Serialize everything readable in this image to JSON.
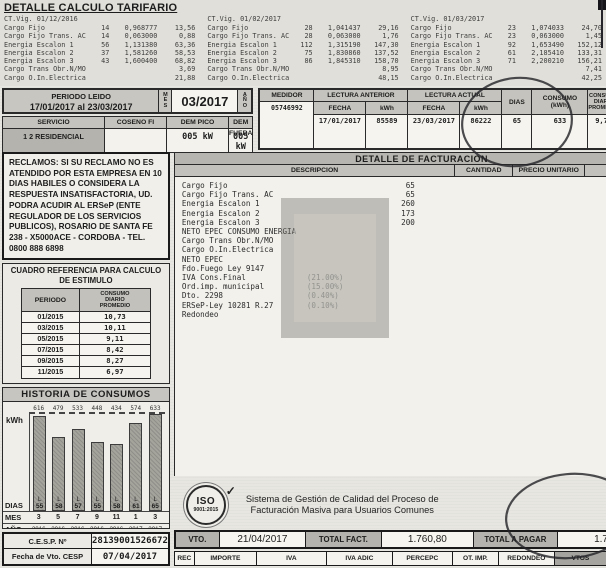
{
  "tarifario": {
    "title": "DETALLE CALCULO TARIFARIO",
    "blocks": [
      {
        "vigencia": "CT.Vig. 01/12/2016",
        "rows": [
          {
            "label": "Cargo Fijo",
            "qty": "14",
            "price": "0,968777",
            "amount": "13,56"
          },
          {
            "label": "Cargo Fijo Trans. AC",
            "qty": "14",
            "price": "0,063000",
            "amount": "0,88"
          },
          {
            "label": "Energia Escalon 1",
            "qty": "56",
            "price": "1,131380",
            "amount": "63,36"
          },
          {
            "label": "Energia Escalon 2",
            "qty": "37",
            "price": "1,581260",
            "amount": "58,53"
          },
          {
            "label": "Energia Escalon 3",
            "qty": "43",
            "price": "1,600400",
            "amount": "68,82"
          },
          {
            "label": "Cargo Trans Obr.N/MO",
            "qty": "",
            "price": "",
            "amount": "3,69"
          },
          {
            "label": "Cargo O.In.Electrica",
            "qty": "",
            "price": "",
            "amount": "21,88"
          }
        ]
      },
      {
        "vigencia": "CT.Vig. 01/02/2017",
        "rows": [
          {
            "label": "Cargo Fijo",
            "qty": "28",
            "price": "1,041437",
            "amount": "29,16"
          },
          {
            "label": "Cargo Fijo Trans. AC",
            "qty": "28",
            "price": "0,063000",
            "amount": "1,76"
          },
          {
            "label": "Energia Escalon 1",
            "qty": "112",
            "price": "1,315190",
            "amount": "147,30"
          },
          {
            "label": "Energia Escalon 2",
            "qty": "75",
            "price": "1,830860",
            "amount": "137,52"
          },
          {
            "label": "Energia Escalon 3",
            "qty": "86",
            "price": "1,845310",
            "amount": "158,70"
          },
          {
            "label": "Cargo Trans Obr.N/MO",
            "qty": "",
            "price": "",
            "amount": "8,95"
          },
          {
            "label": "Cargo O.In.Electrica",
            "qty": "",
            "price": "",
            "amount": "48,15"
          }
        ]
      },
      {
        "vigencia": "CT.Vig. 01/03/2017",
        "rows": [
          {
            "label": "Cargo Fijo",
            "qty": "23",
            "price": "1,074033",
            "amount": "24,70"
          },
          {
            "label": "Cargo Fijo Trans. AC",
            "qty": "23",
            "price": "0,063000",
            "amount": "1,45"
          },
          {
            "label": "Energia Escalon 1",
            "qty": "92",
            "price": "1,653490",
            "amount": "152,12"
          },
          {
            "label": "Energia Escalon 2",
            "qty": "61",
            "price": "2,185410",
            "amount": "133,31"
          },
          {
            "label": "Energia Escalon 3",
            "qty": "71",
            "price": "2,200210",
            "amount": "156,21"
          },
          {
            "label": "Cargo Trans Obr.N/MO",
            "qty": "",
            "price": "",
            "amount": "7,41"
          },
          {
            "label": "Cargo O.In.Electrica",
            "qty": "",
            "price": "",
            "amount": "42,25"
          }
        ]
      }
    ]
  },
  "periodo": {
    "label": "PERIODO LEIDO",
    "rango": "17/01/2017 al 23/03/2017",
    "mes_label": "MES",
    "mes": "03/2017",
    "ano_label": "AÑO",
    "servicio_label": "SERVICIO",
    "servicio": "1 2 RESIDENCIAL",
    "coseno_label": "COSENO FI",
    "coseno": "",
    "dem_pico_label": "DEM PICO",
    "dem_pico": "005 kW",
    "dem_fuera_label": "DEM FUERA",
    "dem_fuera": "005 kW"
  },
  "medidor": {
    "label": "MEDIDOR",
    "numero": "05746992",
    "lectura_anterior_label": "LECTURA ANTERIOR",
    "lectura_actual_label": "LECTURA ACTUAL",
    "fecha_label": "FECHA",
    "kwh_label": "kWh",
    "anterior_fecha": "17/01/2017",
    "anterior_kwh": "85589",
    "actual_fecha": "23/03/2017",
    "actual_kwh": "86222",
    "dias_label": "DIAS",
    "dias": "65",
    "consumo_l1": "CONSUMO",
    "consumo_l2": "(kWh)",
    "consumo": "633",
    "promedio_l1": "CONSUMO",
    "promedio_l2": "DIARIO",
    "promedio_l3": "PROMEDIO",
    "promedio": "9,73"
  },
  "reclamos": {
    "text": "RECLAMOS: SI SU RECLAMO NO ES ATENDIDO POR ESTA EMPRESA EN 10 DIAS HABILES O CONSIDERA LA RESPUESTA INSATISFACTORIA, UD. PODRA ACUDIR AL ERSeP (ENTE REGULADOR DE LOS SERVICIOS PUBLICOS), ROSARIO DE SANTA FE 238 - X5000ACE - CORDOBA - TEL. 0800 888 6898"
  },
  "estimulo": {
    "title1": "CUADRO REFERENCIA PARA CALCULO",
    "title2": "DE ESTIMULO",
    "col_periodo": "PERIODO",
    "col_consumo_l1": "CONSUMO",
    "col_consumo_l2": "DIARIO",
    "col_consumo_l3": "PROMEDIO",
    "rows": [
      {
        "periodo": "01/2015",
        "consumo": "10,73"
      },
      {
        "periodo": "03/2015",
        "consumo": "10,11"
      },
      {
        "periodo": "05/2015",
        "consumo": "9,11"
      },
      {
        "periodo": "07/2015",
        "consumo": "8,42"
      },
      {
        "periodo": "09/2015",
        "consumo": "8,27"
      },
      {
        "periodo": "11/2015",
        "consumo": "6,97"
      }
    ]
  },
  "historia": {
    "title": "HISTORIA DE CONSUMOS",
    "ylabel": "kWh",
    "dias_label": "DIAS",
    "mes_label": "MES",
    "ano_label": "AÑO",
    "leyenda_l": "(L) LECTURA",
    "leyenda_e": "(E) ESTIMADO"
  },
  "chart_data": {
    "type": "bar",
    "title": "HISTORIA DE CONSUMOS",
    "ylabel": "kWh",
    "categories_mes": [
      "3",
      "5",
      "7",
      "9",
      "11",
      "1",
      "3"
    ],
    "categories_ano": [
      "2016",
      "2016",
      "2016",
      "2016",
      "2016",
      "2017",
      "2017"
    ],
    "values": [
      616,
      479,
      533,
      448,
      434,
      574,
      633
    ],
    "dias": [
      "55",
      "58",
      "57",
      "55",
      "58",
      "61",
      "65"
    ],
    "tipo_lectura": [
      "L",
      "L",
      "L",
      "L",
      "L",
      "L",
      "L"
    ],
    "ylim": [
      0,
      650
    ],
    "grid": false,
    "legend": "(L) LECTURA / (E) ESTIMADO"
  },
  "cesp": {
    "nro_label": "C.E.S.P. Nº",
    "nro": "28139001526672",
    "vto_label": "Fecha de Vto. CESP",
    "vto": "07/04/2017"
  },
  "facturacion": {
    "title": "DETALLE DE FACTURACION",
    "col_desc": "DESCRIPCION",
    "col_cant": "CANTIDAD",
    "col_precio": "PRECIO UNITARIO",
    "col_importe": "IMPORTE $",
    "rows": [
      {
        "label": "Cargo Fijo",
        "note": "",
        "qty": "65",
        "amount": "67,42"
      },
      {
        "label": "Cargo Fijo Trans. AC",
        "note": "",
        "qty": "65",
        "amount": "4,09"
      },
      {
        "label": "Energia Escalon 1",
        "note": "",
        "qty": "260",
        "amount": "362,78"
      },
      {
        "label": "Energia Escalon 2",
        "note": "",
        "qty": "173",
        "amount": "329,36"
      },
      {
        "label": "Energia Escalon 3",
        "note": "",
        "qty": "200",
        "amount": "383,73"
      },
      {
        "label": "NETO EPEC CONSUMO ENERGIA",
        "note": "",
        "qty": "",
        "amount": "1.147,38"
      },
      {
        "label": "Cargo Trans Obr.N/MO",
        "note": "",
        "qty": "",
        "amount": "20,05"
      },
      {
        "label": "Cargo O.In.Electrica",
        "note": "",
        "qty": "",
        "amount": "112,28"
      },
      {
        "label": "NETO EPEC",
        "note": "",
        "qty": "",
        "amount": "1.279,71"
      },
      {
        "label": "Fdo.Fuego Ley 9147",
        "note": "",
        "qty": "",
        "amount": "14,00"
      },
      {
        "label": "IVA Cons.Final",
        "note": "(21.00%)",
        "qty": "",
        "amount": "268,74"
      },
      {
        "label": "Ord.imp. municipal",
        "note": "(15.00%)",
        "qty": "",
        "amount": "191,95"
      },
      {
        "label": "Dto. 2298",
        "note": "(0.40%)",
        "qty": "",
        "amount": "5,11"
      },
      {
        "label": "ERSeP-Ley 10281 R.27",
        "note": "(0.10%)",
        "qty": "",
        "amount": "1,27"
      },
      {
        "label": "Redondeo",
        "note": "",
        "qty": "",
        "amount": "0,02"
      }
    ]
  },
  "iso": {
    "name": "ISO",
    "year": "9001:2015",
    "check": "✓",
    "text1": "Sistema de Gestión de Calidad del Proceso de",
    "text2": "Facturación Masiva para Usuarios Comunes"
  },
  "totales": {
    "vto_label": "VTO.",
    "vto": "21/04/2017",
    "total_fact_label": "TOTAL FACT.",
    "total_fact": "1.760,80",
    "total_pagar_label": "TOTAL A PAGAR",
    "total_pagar": "1.760,80"
  },
  "pie": {
    "headers": [
      "REC",
      "IMPORTE",
      "IVA",
      "IVA ADIC",
      "PERCEPC",
      "OT. IMP.",
      "REDONDEO",
      "VTOS",
      "TOTAL C/RECARGO"
    ]
  }
}
